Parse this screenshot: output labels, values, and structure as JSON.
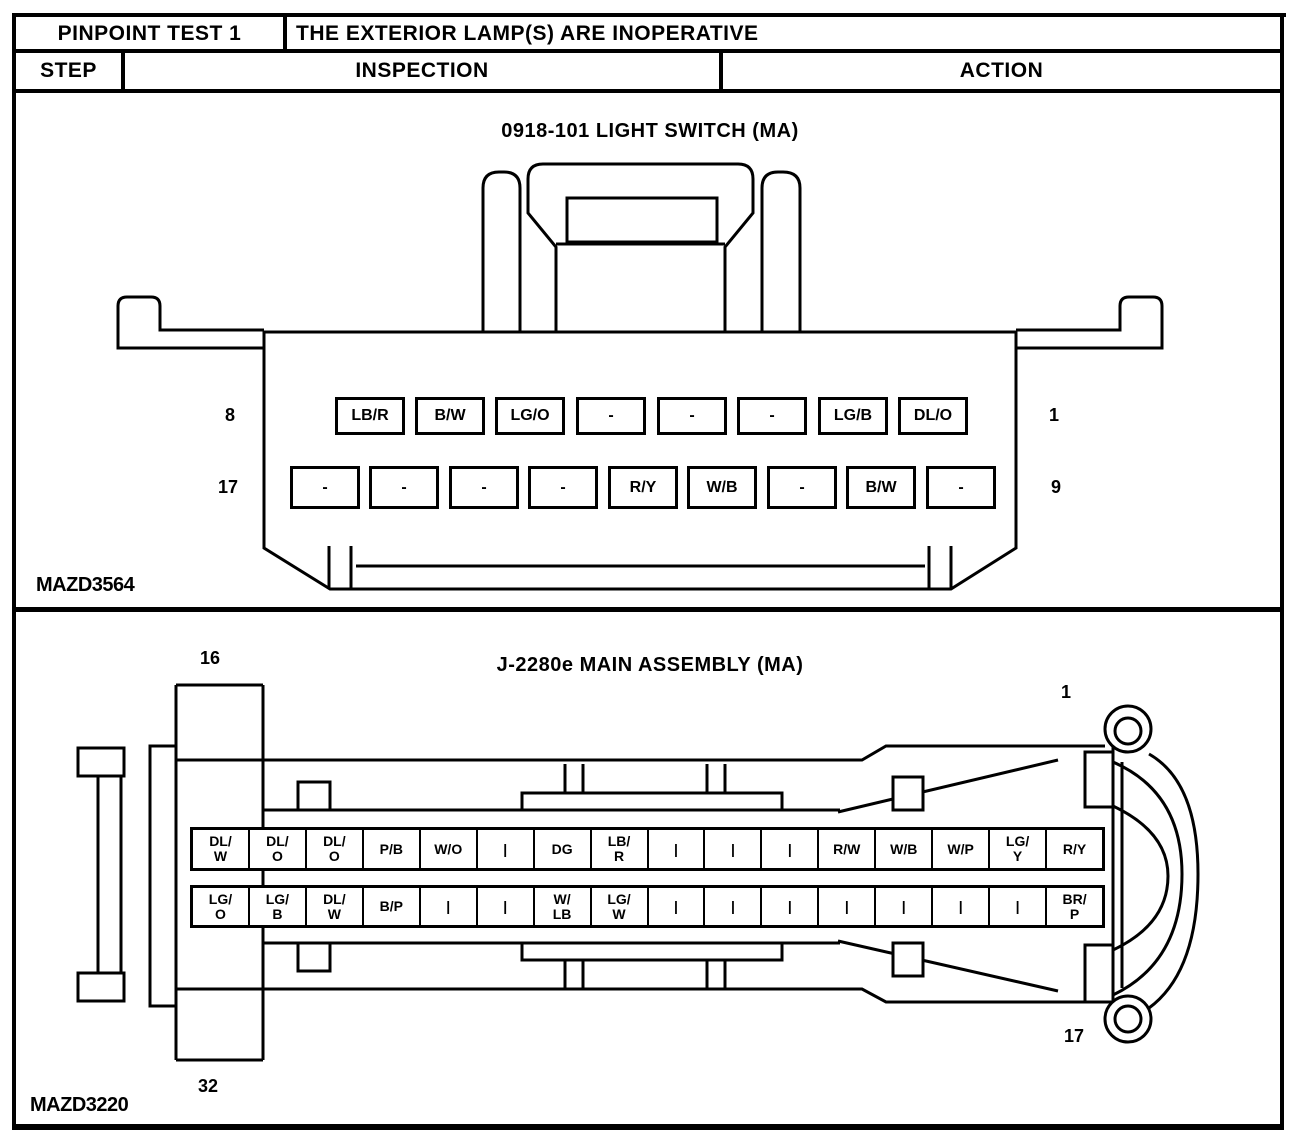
{
  "header": {
    "test_label": "PINPOINT TEST 1",
    "test_title": "THE EXTERIOR LAMP(S) ARE INOPERATIVE",
    "col_step": "STEP",
    "col_inspection": "INSPECTION",
    "col_action": "ACTION"
  },
  "panel1": {
    "title": "0918-101 LIGHT SWITCH (MA)",
    "figure_id": "MAZD3564",
    "pin_row1": {
      "left_pin": "8",
      "right_pin": "1",
      "cells": [
        "LB/R",
        "B/W",
        "LG/O",
        "-",
        "-",
        "-",
        "LG/B",
        "DL/O"
      ]
    },
    "pin_row2": {
      "left_pin": "17",
      "right_pin": "9",
      "cells": [
        "-",
        "-",
        "-",
        "-",
        "R/Y",
        "W/B",
        "-",
        "B/W",
        "-"
      ]
    }
  },
  "panel2": {
    "title": "J-2280e MAIN ASSEMBLY (MA)",
    "figure_id": "MAZD3220",
    "corner_pins": {
      "top_left": "16",
      "top_right": "1",
      "bottom_left": "32",
      "bottom_right": "17"
    },
    "pin_row1": {
      "cells": [
        "DL/\nW",
        "DL/\nO",
        "DL/\nO",
        "P/B",
        "W/O",
        "|",
        "DG",
        "LB/\nR",
        "|",
        "|",
        "|",
        "R/W",
        "W/B",
        "W/P",
        "LG/\nY",
        "R/Y"
      ]
    },
    "pin_row2": {
      "cells": [
        "LG/\nO",
        "LG/\nB",
        "DL/\nW",
        "B/P",
        "|",
        "|",
        "W/\nLB",
        "LG/\nW",
        "|",
        "|",
        "|",
        "|",
        "|",
        "|",
        "|",
        "BR/\nP"
      ]
    }
  }
}
